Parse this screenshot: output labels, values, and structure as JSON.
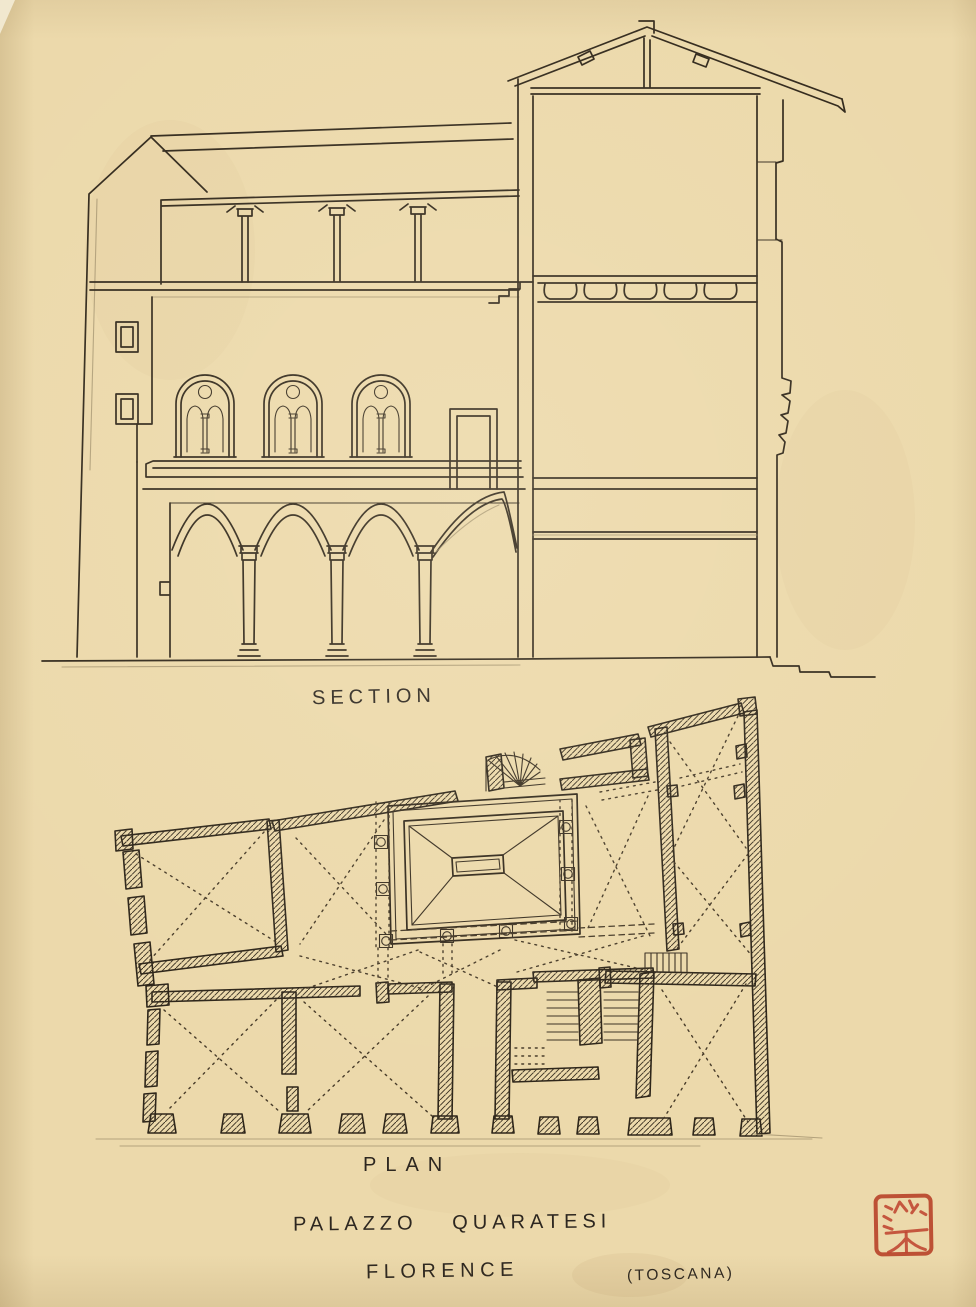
{
  "labels": {
    "section": "SECTION",
    "plan": "PLAN"
  },
  "caption": {
    "building": "PALAZZO QUARATESI",
    "city": "FLORENCE",
    "region": "(TOSCANA)"
  },
  "seal": {
    "name": "red-seal-stamp",
    "color": "#bf4430"
  },
  "colors": {
    "paper": "#ecd9ab",
    "ink": "#32291c",
    "pencil": "#9b8a68",
    "seal_red": "#bf4430"
  }
}
